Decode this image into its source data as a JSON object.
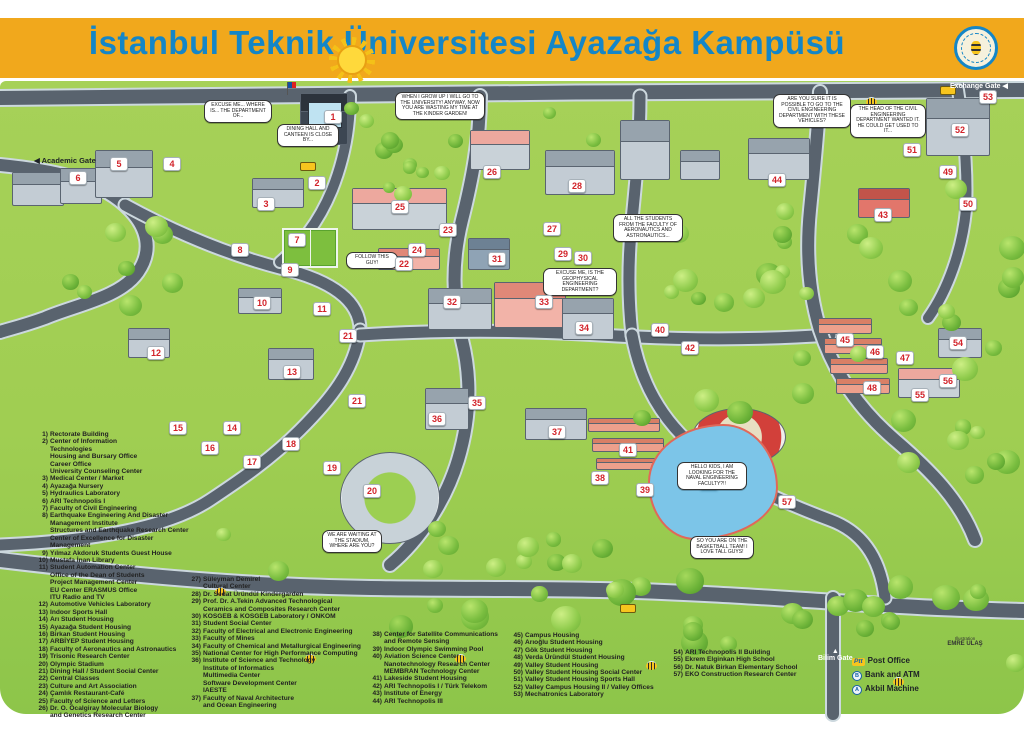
{
  "banner": {
    "title": "İstanbul Teknik Üniversitesi Ayazağa Kampüsü",
    "logo": "itu-seal",
    "bg_color": "#F1A81C",
    "title_color": "#1486C7"
  },
  "colors": {
    "grass": "#A0CE52",
    "road": "#59636E",
    "lake": "#7CC5E8",
    "marker_number": "#D2232A"
  },
  "map": {
    "gates": [
      {
        "id": "academic",
        "label": "Academic Gate",
        "arrow": "◀",
        "x": 34,
        "y": 156,
        "theme": "dark"
      },
      {
        "id": "exchange",
        "label": "Exchange Gate",
        "arrow": "◀",
        "x": 950,
        "y": 82,
        "theme": "light"
      },
      {
        "id": "bilim",
        "label": "Bilim Gate",
        "arrow": "▲",
        "x": 818,
        "y": 648,
        "theme": "light"
      }
    ],
    "markers": [
      {
        "n": "1",
        "x": 333,
        "y": 117
      },
      {
        "n": "2",
        "x": 317,
        "y": 183
      },
      {
        "n": "3",
        "x": 266,
        "y": 204
      },
      {
        "n": "4",
        "x": 172,
        "y": 164
      },
      {
        "n": "5",
        "x": 119,
        "y": 164
      },
      {
        "n": "6",
        "x": 78,
        "y": 178
      },
      {
        "n": "7",
        "x": 297,
        "y": 240
      },
      {
        "n": "8",
        "x": 240,
        "y": 250
      },
      {
        "n": "9",
        "x": 290,
        "y": 270
      },
      {
        "n": "10",
        "x": 262,
        "y": 303
      },
      {
        "n": "11",
        "x": 322,
        "y": 309
      },
      {
        "n": "12",
        "x": 156,
        "y": 353
      },
      {
        "n": "13",
        "x": 292,
        "y": 372
      },
      {
        "n": "14",
        "x": 232,
        "y": 428
      },
      {
        "n": "15",
        "x": 178,
        "y": 428
      },
      {
        "n": "16",
        "x": 210,
        "y": 448
      },
      {
        "n": "17",
        "x": 252,
        "y": 462
      },
      {
        "n": "18",
        "x": 291,
        "y": 444
      },
      {
        "n": "19",
        "x": 332,
        "y": 468
      },
      {
        "n": "20",
        "x": 372,
        "y": 491
      },
      {
        "n": "21",
        "x": 348,
        "y": 336
      },
      {
        "n": "21",
        "x": 357,
        "y": 401
      },
      {
        "n": "22",
        "x": 404,
        "y": 264
      },
      {
        "n": "23",
        "x": 448,
        "y": 230
      },
      {
        "n": "24",
        "x": 417,
        "y": 250
      },
      {
        "n": "25",
        "x": 400,
        "y": 207
      },
      {
        "n": "26",
        "x": 492,
        "y": 172
      },
      {
        "n": "27",
        "x": 552,
        "y": 229
      },
      {
        "n": "28",
        "x": 577,
        "y": 186
      },
      {
        "n": "29",
        "x": 563,
        "y": 254
      },
      {
        "n": "30",
        "x": 583,
        "y": 258
      },
      {
        "n": "31",
        "x": 497,
        "y": 259
      },
      {
        "n": "32",
        "x": 452,
        "y": 302
      },
      {
        "n": "33",
        "x": 544,
        "y": 302
      },
      {
        "n": "34",
        "x": 584,
        "y": 328
      },
      {
        "n": "35",
        "x": 477,
        "y": 403
      },
      {
        "n": "36",
        "x": 437,
        "y": 419
      },
      {
        "n": "37",
        "x": 557,
        "y": 432
      },
      {
        "n": "38",
        "x": 600,
        "y": 478
      },
      {
        "n": "39",
        "x": 645,
        "y": 490
      },
      {
        "n": "40",
        "x": 660,
        "y": 330
      },
      {
        "n": "41",
        "x": 628,
        "y": 450
      },
      {
        "n": "42",
        "x": 690,
        "y": 348
      },
      {
        "n": "43",
        "x": 883,
        "y": 215
      },
      {
        "n": "44",
        "x": 777,
        "y": 180
      },
      {
        "n": "45",
        "x": 845,
        "y": 340
      },
      {
        "n": "46",
        "x": 875,
        "y": 352
      },
      {
        "n": "47",
        "x": 905,
        "y": 358
      },
      {
        "n": "48",
        "x": 872,
        "y": 388
      },
      {
        "n": "49",
        "x": 948,
        "y": 172
      },
      {
        "n": "50",
        "x": 968,
        "y": 204
      },
      {
        "n": "51",
        "x": 912,
        "y": 150
      },
      {
        "n": "52",
        "x": 960,
        "y": 130
      },
      {
        "n": "53",
        "x": 988,
        "y": 97
      },
      {
        "n": "54",
        "x": 958,
        "y": 343
      },
      {
        "n": "55",
        "x": 920,
        "y": 395
      },
      {
        "n": "56",
        "x": 948,
        "y": 381
      },
      {
        "n": "57",
        "x": 787,
        "y": 502
      }
    ],
    "speech_bubbles": [
      {
        "x": 440,
        "y": 92,
        "w": 82,
        "text": "WHEN I GROW UP I WILL GO TO THE UNIVERSITY! ANYWAY, NOW YOU ARE WASTING MY TIME AT THE KINDER GARDEN!"
      },
      {
        "x": 238,
        "y": 100,
        "w": 60,
        "text": "EXCUSE ME... WHERE IS... THE DEPARTMENT OF..."
      },
      {
        "x": 308,
        "y": 124,
        "w": 54,
        "text": "DINING HALL AND CANTEEN IS CLOSE BY..."
      },
      {
        "x": 812,
        "y": 94,
        "w": 70,
        "text": "ARE YOU SURE IT IS POSSIBLE TO GO TO THE CIVIL ENGINEERING DEPARTMENT WITH THESE VEHICLES?"
      },
      {
        "x": 888,
        "y": 104,
        "w": 68,
        "text": "THE HEAD OF THE CIVIL ENGINEERING DEPARTMENT WANTED IT. HE COULD GET USED TO IT..."
      },
      {
        "x": 372,
        "y": 252,
        "w": 44,
        "text": "FOLLOW THIS GUY!"
      },
      {
        "x": 580,
        "y": 268,
        "w": 66,
        "text": "EXCUSE ME, IS THE GEOPHYSICAL ENGINEERING DEPARTMENT?"
      },
      {
        "x": 648,
        "y": 214,
        "w": 62,
        "text": "ALL THE STUDENTS FROM THE FACULTY OF AERONAUTICS AND ASTRONAUTICS..."
      },
      {
        "x": 712,
        "y": 462,
        "w": 62,
        "text": "HELLO KIDS, I AM LOOKING FOR THE NAVAL ENGINEERING FACULTY?!!"
      },
      {
        "x": 722,
        "y": 536,
        "w": 56,
        "text": "SO YOU ARE ON THE BASKETBALL TEAM! I LOVE TALL GUYS!"
      },
      {
        "x": 352,
        "y": 530,
        "w": 52,
        "text": "WE ARE WAITING AT THE STADIUM, WHERE ARE YOU?"
      }
    ],
    "credit": {
      "line1": "Illustration",
      "line2": "EMRE ULAŞ"
    }
  },
  "legend": {
    "columns": [
      {
        "items": [
          {
            "num": "1",
            "lines": [
              "Rectorate Building"
            ]
          },
          {
            "num": "2",
            "lines": [
              "Center of Information",
              "Technologies",
              "Housing and Bursary Office",
              "Career Office",
              "University Counseling Center"
            ]
          },
          {
            "num": "3",
            "lines": [
              "Medical Center / Market"
            ]
          },
          {
            "num": "4",
            "lines": [
              "Ayazağa Nursery"
            ]
          },
          {
            "num": "5",
            "lines": [
              "Hydraulics Laboratory"
            ]
          },
          {
            "num": "6",
            "lines": [
              "ARI Technopolis I"
            ]
          },
          {
            "num": "7",
            "lines": [
              "Faculty of Civil Engineering"
            ]
          },
          {
            "num": "8",
            "lines": [
              "Earthquake Engineering And Disaster",
              "Management Institute",
              "Structures and Earthquake Research Center",
              "Center of Excellence for Disaster Management"
            ]
          },
          {
            "num": "9",
            "lines": [
              "Yılmaz Akdoruk Students Guest House"
            ]
          },
          {
            "num": "10",
            "lines": [
              "Mustafa İnan Library"
            ]
          },
          {
            "num": "11",
            "lines": [
              "Student Automation Center",
              "Office of the Dean of Students",
              "Project Management Center",
              "EU Center ERASMUS Office",
              "ITU Radio and TV"
            ]
          },
          {
            "num": "12",
            "lines": [
              "Automotive Vehicles Laboratory"
            ]
          },
          {
            "num": "13",
            "lines": [
              "Indoor Sports Hall"
            ]
          },
          {
            "num": "14",
            "lines": [
              "Arı Student Housing"
            ]
          },
          {
            "num": "15",
            "lines": [
              "Ayazağa Student Housing"
            ]
          },
          {
            "num": "16",
            "lines": [
              "Birkan Student Housing"
            ]
          },
          {
            "num": "17",
            "lines": [
              "ARBİYEP Student Housing"
            ]
          },
          {
            "num": "18",
            "lines": [
              "Faculty of Aeronautics and Astronautics"
            ]
          },
          {
            "num": "19",
            "lines": [
              "Trisonic Research Center"
            ]
          },
          {
            "num": "20",
            "lines": [
              "Olympic Stadium"
            ]
          },
          {
            "num": "21",
            "lines": [
              "Dining Hall / Student Social Center"
            ]
          },
          {
            "num": "22",
            "lines": [
              "Central Classes"
            ]
          },
          {
            "num": "23",
            "lines": [
              "Culture and Art Association"
            ]
          },
          {
            "num": "24",
            "lines": [
              "Çamlık Restaurant-Café"
            ]
          },
          {
            "num": "25",
            "lines": [
              "Faculty of Science and Letters"
            ]
          },
          {
            "num": "26",
            "lines": [
              "Dr. O. Öcalgiray Molecular Biology",
              "and Genetics Research Center"
            ]
          }
        ]
      },
      {
        "items": [
          {
            "num": "27",
            "lines": [
              "Süleyman Demirel",
              "Cultural Center"
            ]
          },
          {
            "num": "28",
            "lines": [
              "Dr. Sedat Üründül Kindergarden"
            ]
          },
          {
            "num": "29",
            "lines": [
              "Prof. Dr. A.Tekin Advanced Technological",
              "Ceramics and Composites Research Center"
            ]
          },
          {
            "num": "30",
            "lines": [
              "KOSGEB & KOSGEB Laboratory / ONKOM"
            ]
          },
          {
            "num": "31",
            "lines": [
              "Student Social Center"
            ]
          },
          {
            "num": "32",
            "lines": [
              "Faculty of Electrical and Electronic Engineering"
            ]
          },
          {
            "num": "33",
            "lines": [
              "Faculty of Mines"
            ]
          },
          {
            "num": "34",
            "lines": [
              "Faculty of Chemical and Metallurgical Engineering"
            ]
          },
          {
            "num": "35",
            "lines": [
              "National Center for High Performance Computing"
            ]
          },
          {
            "num": "36",
            "lines": [
              "Institute of Science and Technology",
              "Institute of Informatics",
              "Multimedia Center",
              "Software Development Center",
              "IAESTE"
            ]
          },
          {
            "num": "37",
            "lines": [
              "Faculty of Naval Architecture",
              "and Ocean Engineering"
            ]
          }
        ]
      },
      {
        "items": [
          {
            "num": "38",
            "lines": [
              "Center for Satellite Communications",
              "and Remote Sensing"
            ]
          },
          {
            "num": "39",
            "lines": [
              "Indoor Olympic Swimming Pool"
            ]
          },
          {
            "num": "40",
            "lines": [
              "Aviation Science Center",
              "Nanotechnology Research Center",
              "MEMBRAN Technology Center"
            ]
          },
          {
            "num": "41",
            "lines": [
              "Lakeside Student Housing"
            ]
          },
          {
            "num": "42",
            "lines": [
              "ARI Technopolis I / Türk Telekom"
            ]
          },
          {
            "num": "43",
            "lines": [
              "Institute of Energy"
            ]
          },
          {
            "num": "44",
            "lines": [
              "ARI Technopolis III"
            ]
          }
        ]
      },
      {
        "items": [
          {
            "num": "45",
            "lines": [
              "Campus Housing"
            ]
          },
          {
            "num": "46",
            "lines": [
              "Arıoğlu Student Housing"
            ]
          },
          {
            "num": "47",
            "lines": [
              "Gök Student Housing"
            ]
          },
          {
            "num": "48",
            "lines": [
              "Verda Üründül Student Housing"
            ]
          },
          {
            "num": "49",
            "lines": [
              "Valley Student Housing"
            ]
          },
          {
            "num": "50",
            "lines": [
              "Valley Student Housing Social Center"
            ]
          },
          {
            "num": "51",
            "lines": [
              "Valley Student Housing Sports Hall"
            ]
          },
          {
            "num": "52",
            "lines": [
              "Valley Campus Housing II / Valley Offices"
            ]
          },
          {
            "num": "53",
            "lines": [
              "Mechatronics Laboratory"
            ]
          }
        ]
      },
      {
        "items": [
          {
            "num": "54",
            "lines": [
              "ARI Technopolis II Building"
            ]
          },
          {
            "num": "55",
            "lines": [
              "Ekrem Elginkan High School"
            ]
          },
          {
            "num": "56",
            "lines": [
              "Dr. Natuk Birkan Elementary School"
            ]
          },
          {
            "num": "57",
            "lines": [
              "EKO Construction Research Center"
            ]
          }
        ]
      }
    ],
    "symbols": [
      {
        "icon": "ptt-icon",
        "badge": "Ptt",
        "label": "Post Office"
      },
      {
        "icon": "bank-icon",
        "badge": "B",
        "label": "Bank and ATM"
      },
      {
        "icon": "akbil-icon",
        "badge": "A",
        "label": "Akbil Machine"
      }
    ]
  }
}
